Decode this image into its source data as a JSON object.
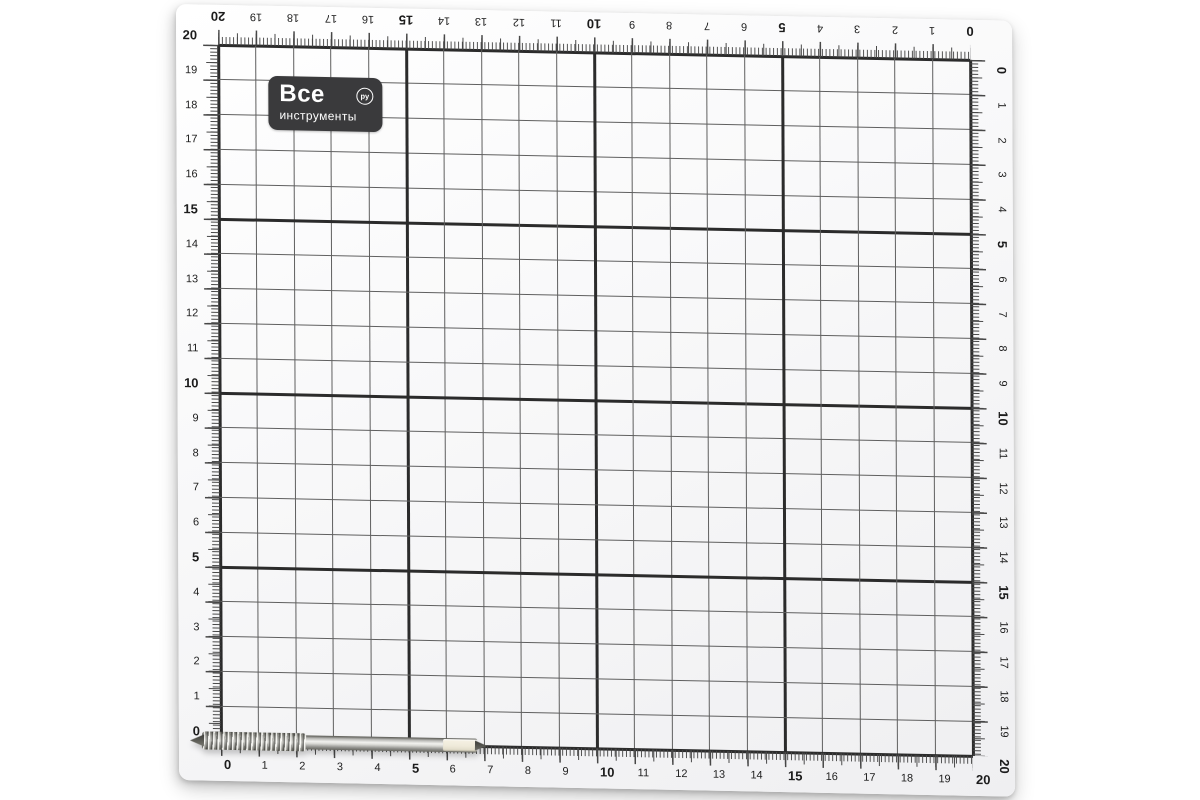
{
  "brand": {
    "line1": "Все",
    "line2": "инструменты",
    "badge": "ру"
  },
  "mat": {
    "units": "cm",
    "max": 20,
    "major_interval": 5,
    "minor_per_unit": 10,
    "rulers": {
      "top": {
        "direction": "right-to-left",
        "orientation": "upside-down",
        "values": [
          "20",
          "19",
          "18",
          "17",
          "16",
          "15",
          "14",
          "13",
          "12",
          "11",
          "10",
          "9",
          "8",
          "7",
          "6",
          "5",
          "4",
          "3",
          "2",
          "1",
          "0"
        ]
      },
      "bottom": {
        "direction": "left-to-right",
        "orientation": "upright",
        "values": [
          "0",
          "1",
          "2",
          "3",
          "4",
          "5",
          "6",
          "7",
          "8",
          "9",
          "10",
          "11",
          "12",
          "13",
          "14",
          "15",
          "16",
          "17",
          "18",
          "19",
          "20"
        ]
      },
      "left": {
        "direction": "top-to-bottom",
        "orientation": "upright",
        "values": [
          "20",
          "19",
          "18",
          "17",
          "16",
          "15",
          "14",
          "13",
          "12",
          "11",
          "10",
          "9",
          "8",
          "7",
          "6",
          "5",
          "4",
          "3",
          "2",
          "1",
          "0"
        ]
      },
      "right": {
        "direction": "top-to-bottom",
        "orientation": "rotated-90",
        "values": [
          "0",
          "1",
          "2",
          "3",
          "4",
          "5",
          "6",
          "7",
          "8",
          "9",
          "10",
          "11",
          "12",
          "13",
          "14",
          "15",
          "16",
          "17",
          "18",
          "19",
          "20"
        ]
      }
    },
    "colors": {
      "surface": "#fafafb",
      "minor_line": "#5f5f5f",
      "major_line": "#2b2b2b",
      "tick": "#474747",
      "number": "#1c1c1c",
      "logo_bg": "#3a3a3c",
      "page_background": "#ffffff"
    }
  },
  "foreground_object": {
    "name": "metal-thread-tap",
    "position": "bottom-left, tip at 0 mark"
  }
}
